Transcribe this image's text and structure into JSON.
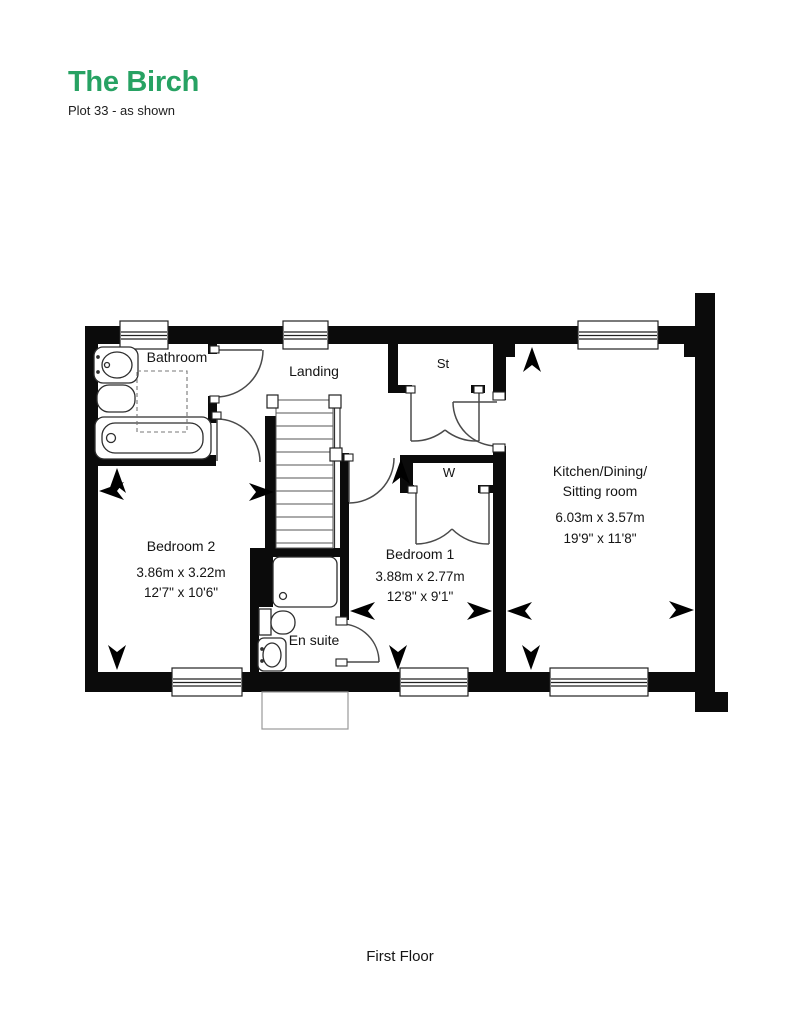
{
  "header": {
    "title": "The Birch",
    "subtitle": "Plot 33 - as shown",
    "accent_color": "#27A263"
  },
  "rooms": {
    "bathroom": {
      "label": "Bathroom"
    },
    "landing": {
      "label": "Landing"
    },
    "storage_cupboard": {
      "label": "St"
    },
    "wardrobe": {
      "label": "W"
    },
    "bedroom2": {
      "label": "Bedroom 2",
      "metric": "3.86m x 3.22m",
      "imperial": "12'7\" x 10'6\""
    },
    "bedroom1": {
      "label": "Bedroom 1",
      "metric": "3.88m x 2.77m",
      "imperial": "12'8\" x 9'1\""
    },
    "kitchen": {
      "label_line1": "Kitchen/Dining/",
      "label_line2": "Sitting room",
      "metric": "6.03m x 3.57m",
      "imperial": "19'9\" x 11'8\""
    },
    "ensuite": {
      "label": "En suite"
    }
  },
  "floor": {
    "label": "First Floor"
  }
}
